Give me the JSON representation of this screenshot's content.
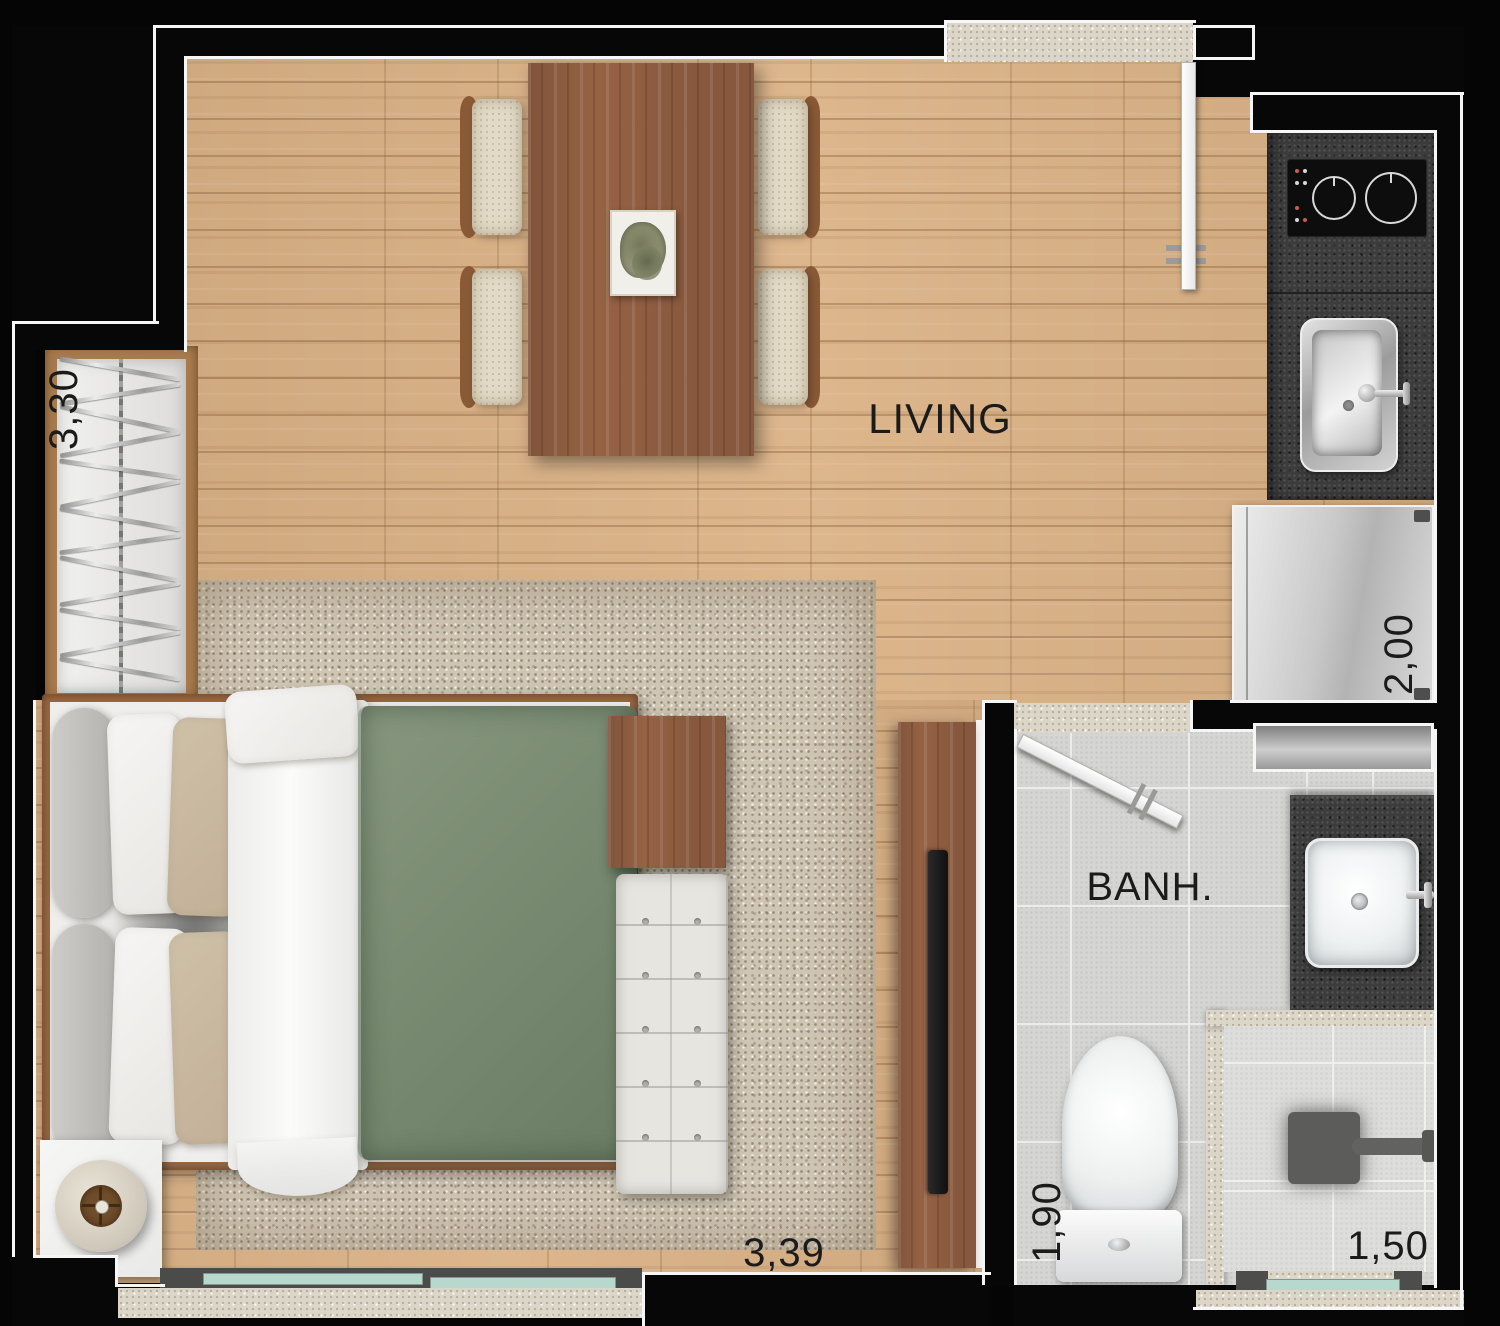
{
  "plan_title": "Studio apartment floor plan",
  "rooms": {
    "living": {
      "label": "LIVING"
    },
    "bathroom": {
      "label": "BANH."
    }
  },
  "dimensions": {
    "closet": "3,30",
    "kitchen": "2,00",
    "bedroom": "3,39",
    "bathroom_depth": "1,90",
    "bathroom_width": "1,50"
  },
  "colors": {
    "wall": "#070707",
    "outline": "#f6f6f6",
    "wood_floor": "#dbb286",
    "furniture_wood": "#966244",
    "duvet_green": "#7d8f78",
    "glass_teal": "#b7d8cc",
    "granite": "#3c3c3c"
  }
}
